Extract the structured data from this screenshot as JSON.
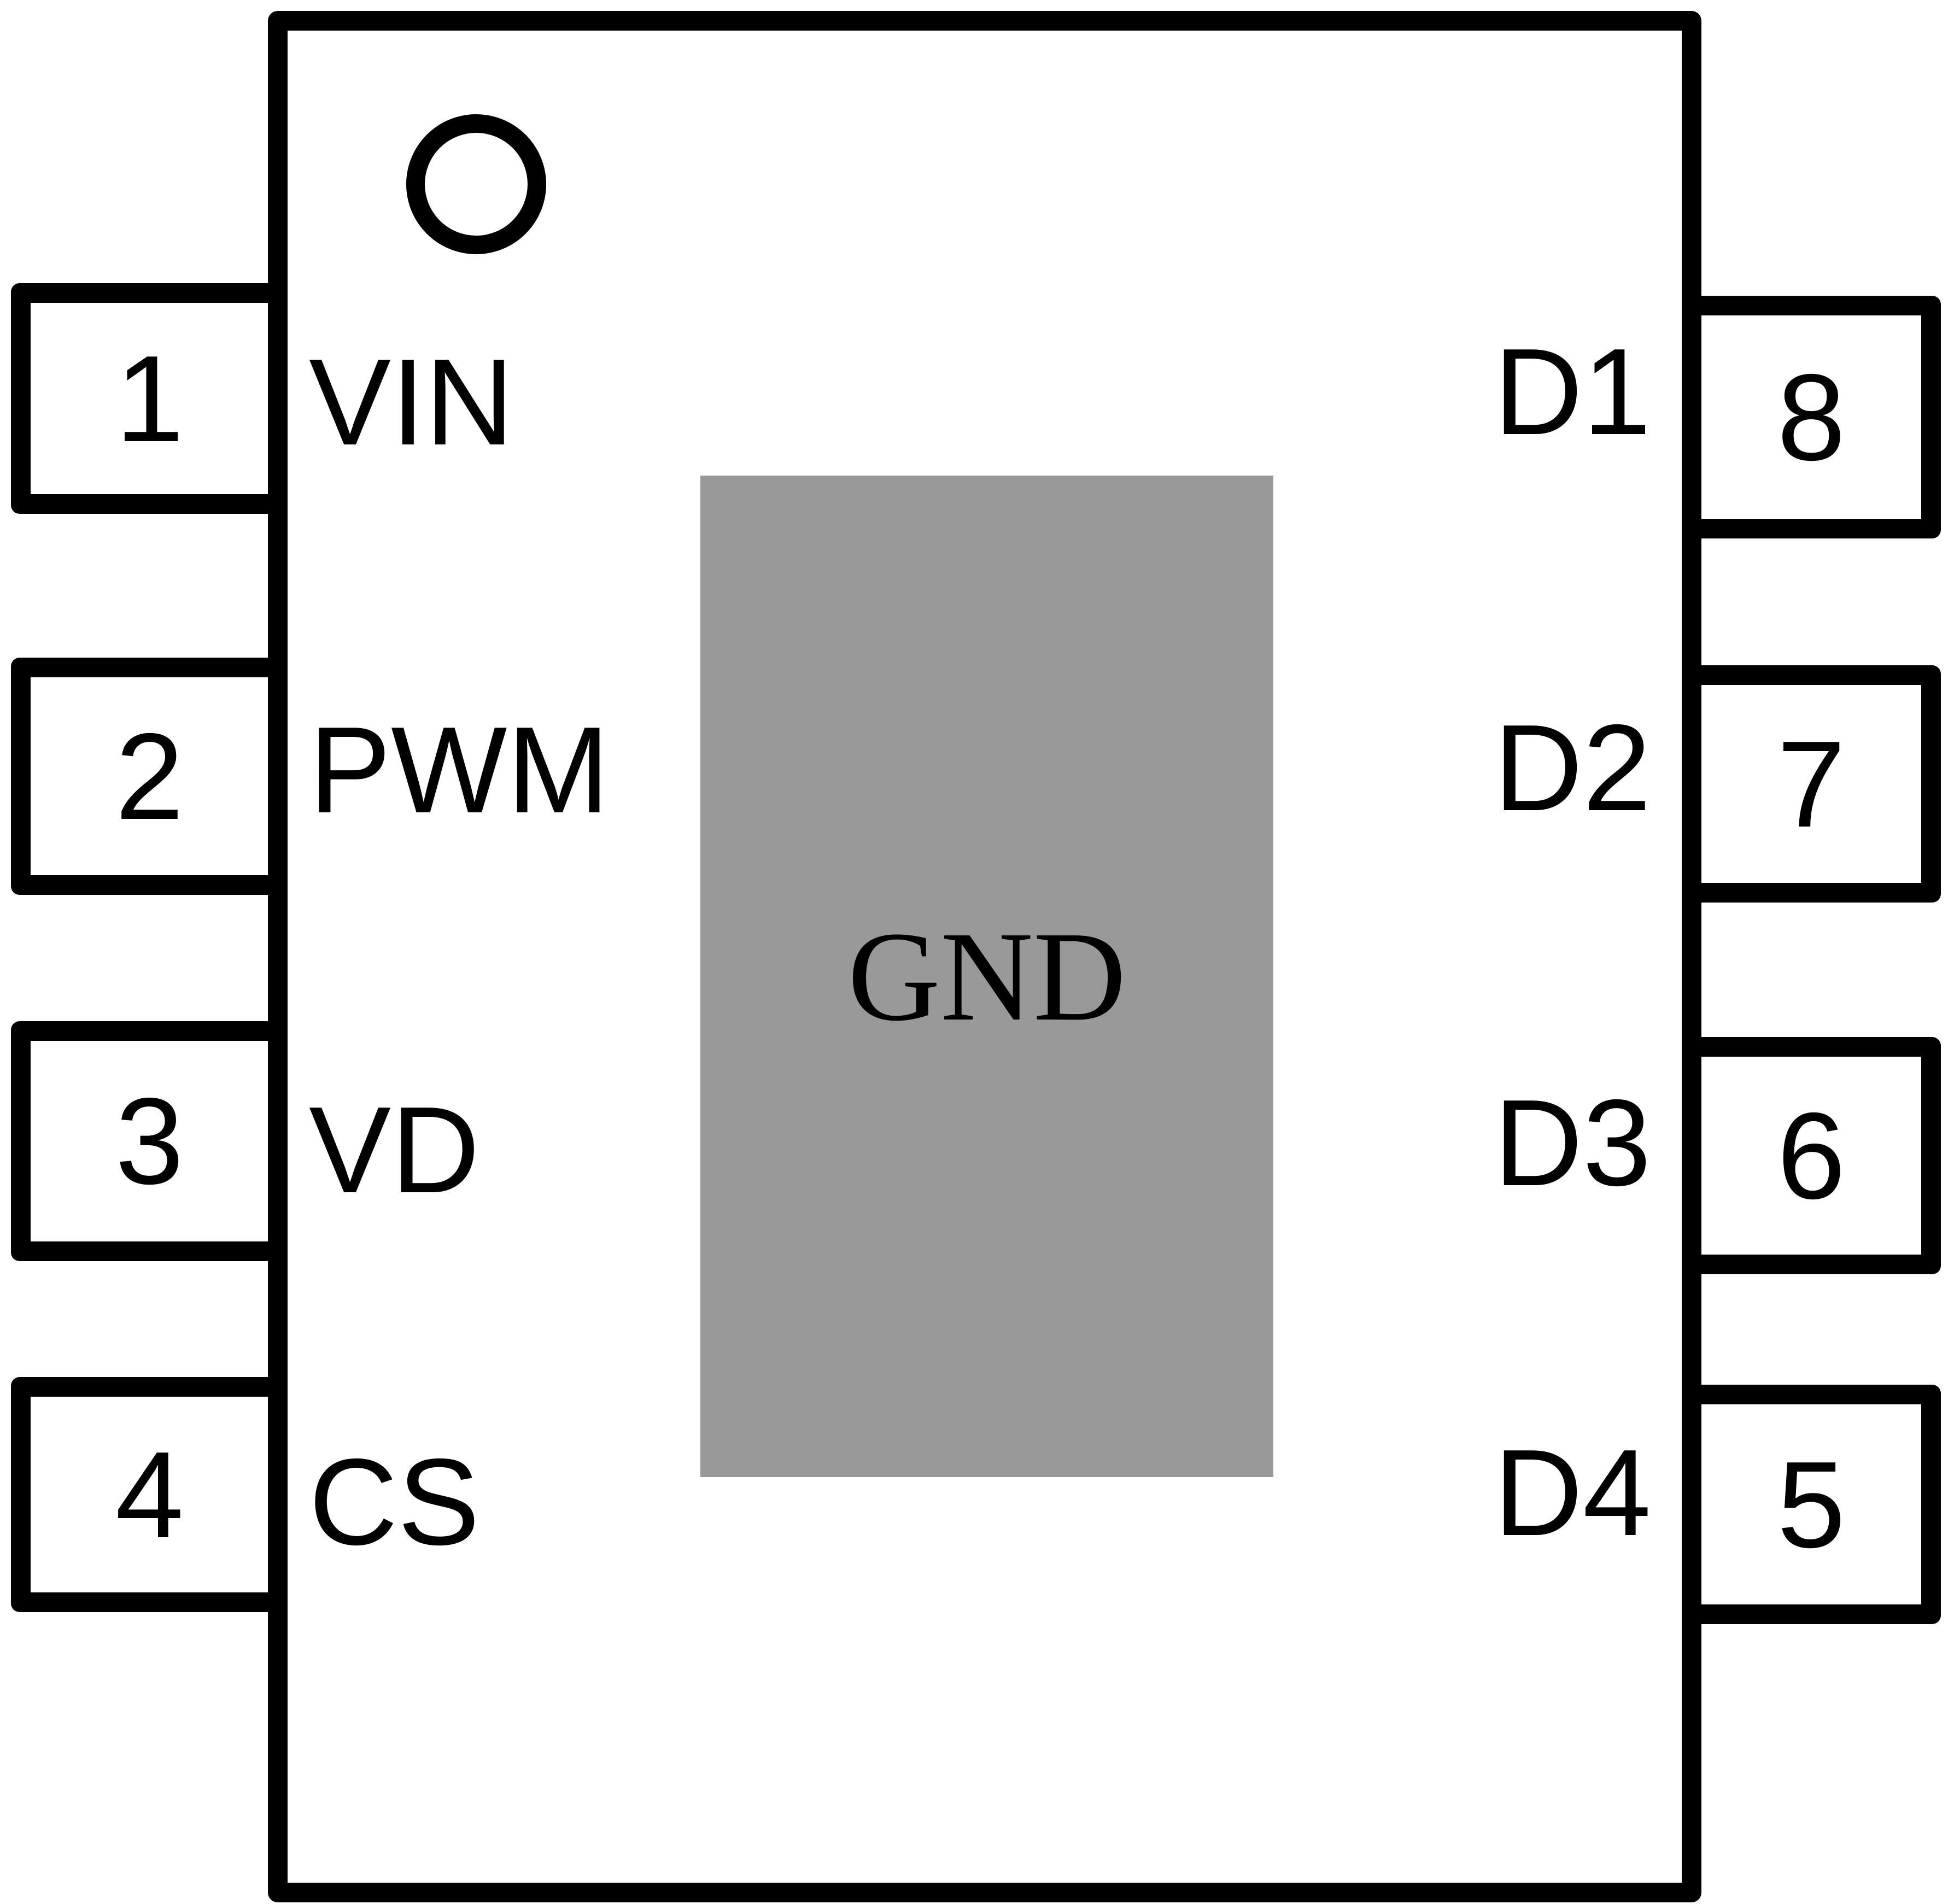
{
  "diagram": {
    "gnd_label": "GND",
    "colors": {
      "line": "#000000",
      "background": "#ffffff",
      "pad_fill": "#999999"
    },
    "left_pins": [
      {
        "number": "1",
        "label": "VIN"
      },
      {
        "number": "2",
        "label": "PWM"
      },
      {
        "number": "3",
        "label": "VD"
      },
      {
        "number": "4",
        "label": "CS"
      }
    ],
    "right_pins": [
      {
        "number": "8",
        "label": "D1"
      },
      {
        "number": "7",
        "label": "D2"
      },
      {
        "number": "6",
        "label": "D3"
      },
      {
        "number": "5",
        "label": "D4"
      }
    ]
  }
}
